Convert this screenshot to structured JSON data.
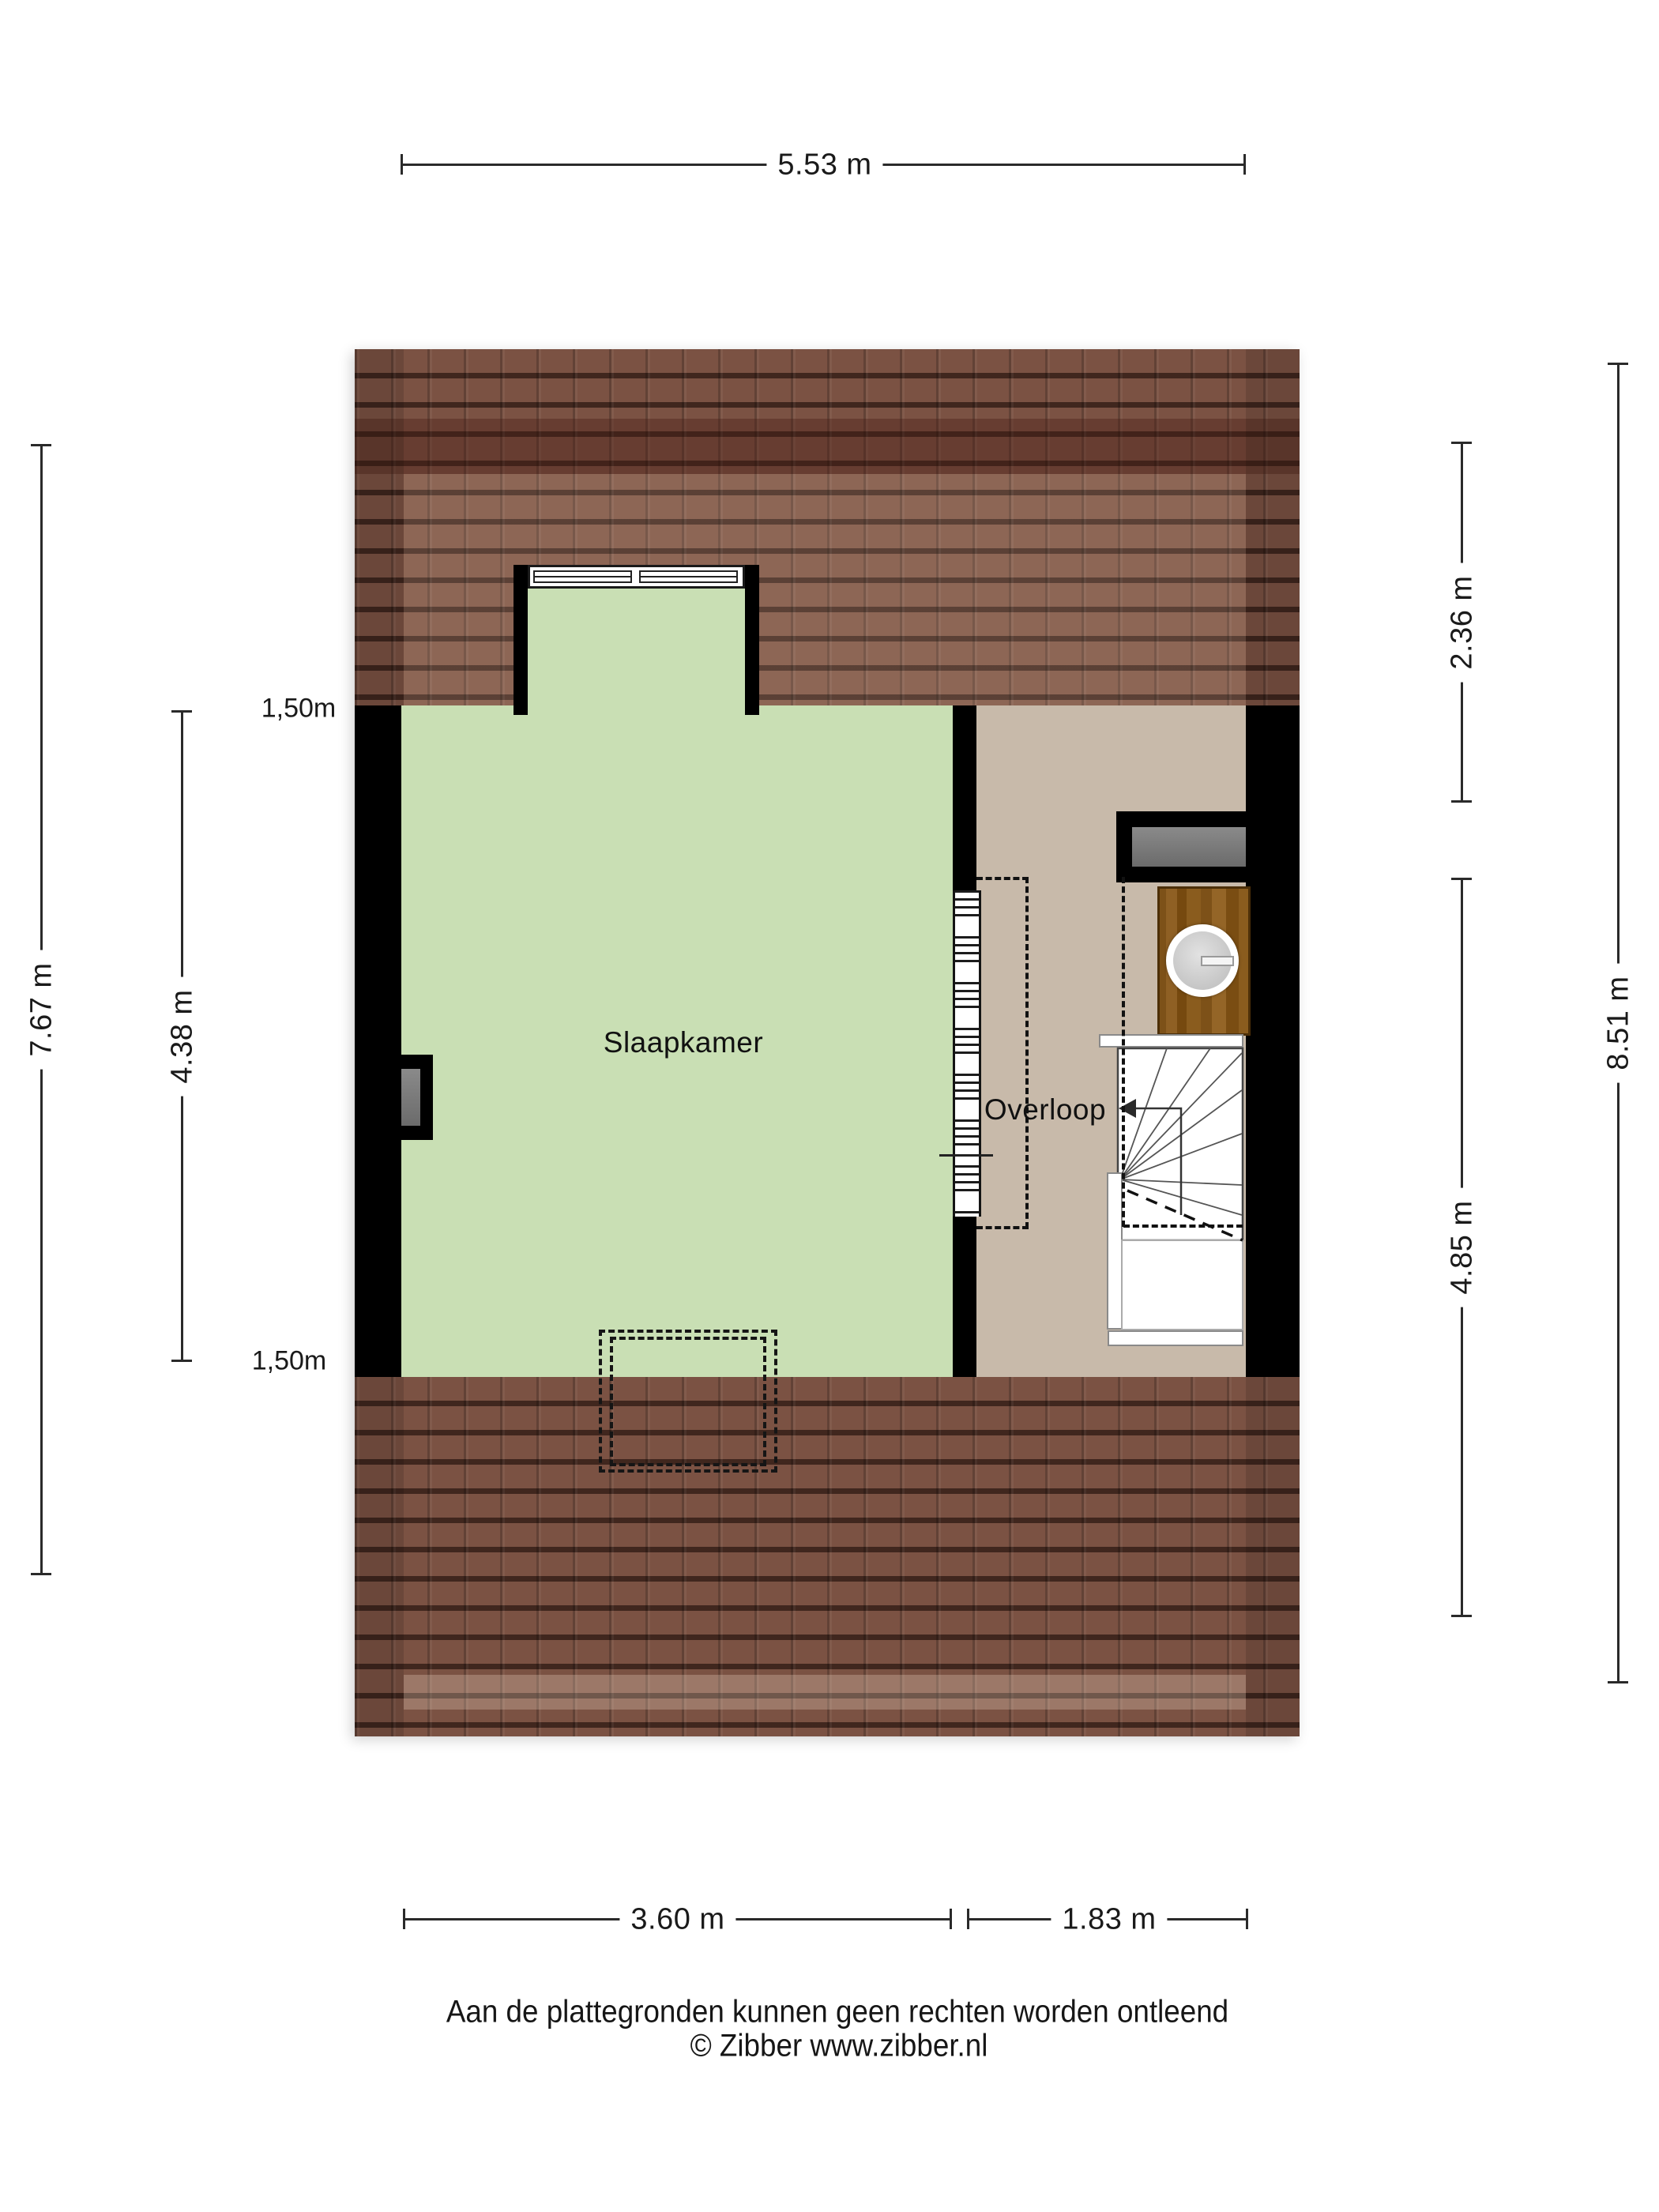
{
  "plan": {
    "rooms": {
      "bedroom": "Slaapkamer",
      "landing": "Overloop"
    },
    "dims": {
      "top": "5.53 m",
      "left_outer": "7.67 m",
      "left_inner": "4.38 m",
      "height_top": "1,50m",
      "height_bottom": "1,50m",
      "right_top": "2.36 m",
      "right_bottom": "4.85 m",
      "right_outer": "8.51 m",
      "bottom_left": "3.60 m",
      "bottom_right": "1.83 m"
    },
    "footer": {
      "line1": "Aan de plattegronden kunnen geen rechten worden ontleend",
      "line2": "© Zibber www.zibber.nl"
    },
    "colors": {
      "roof": "#7b5243",
      "bedroom_floor": "#c9dfb4",
      "landing_floor": "#c8baaa",
      "wall": "#000000",
      "wood": "#8a5c1e"
    }
  }
}
